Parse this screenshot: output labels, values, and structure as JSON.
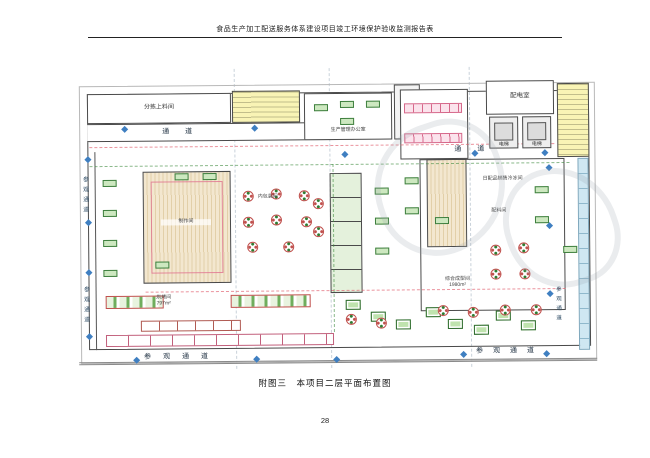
{
  "document": {
    "header_title": "食品生产加工配送服务体系建设项目竣工环境保护验收监测报告表",
    "figure_caption": "附图三　本项目二层平面布置图",
    "page_number": "28"
  },
  "plan": {
    "corridor_label": "通  道",
    "visitor_corridor_vertical": "参观通道",
    "visitor_corridor_horizontal": "参 观 通 道",
    "rooms": {
      "sorting_feed_room": "分拣上料间",
      "production_office": "生产管理办公室",
      "power_distribution_room": "配电室",
      "elevator": "电梯",
      "inner_packaging_room": "内包装间",
      "making_room": "制作间",
      "composite_forming_room": "综合成型间",
      "composite_forming_area": "1980m²",
      "baking_room": "烘烤间",
      "baking_area": "797m²",
      "ingredient_room": "配料间",
      "daily_cold_room": "日配品销售冷冻间"
    },
    "colors": {
      "marker_blue": "#3f7fc1",
      "equipment_green": "#4e8f3f",
      "stair_yellow": "#f7f1ae",
      "hatch_tan": "#e6d3a8",
      "pink_line": "#e0718e",
      "wall_gray": "#4a4a4a"
    }
  }
}
